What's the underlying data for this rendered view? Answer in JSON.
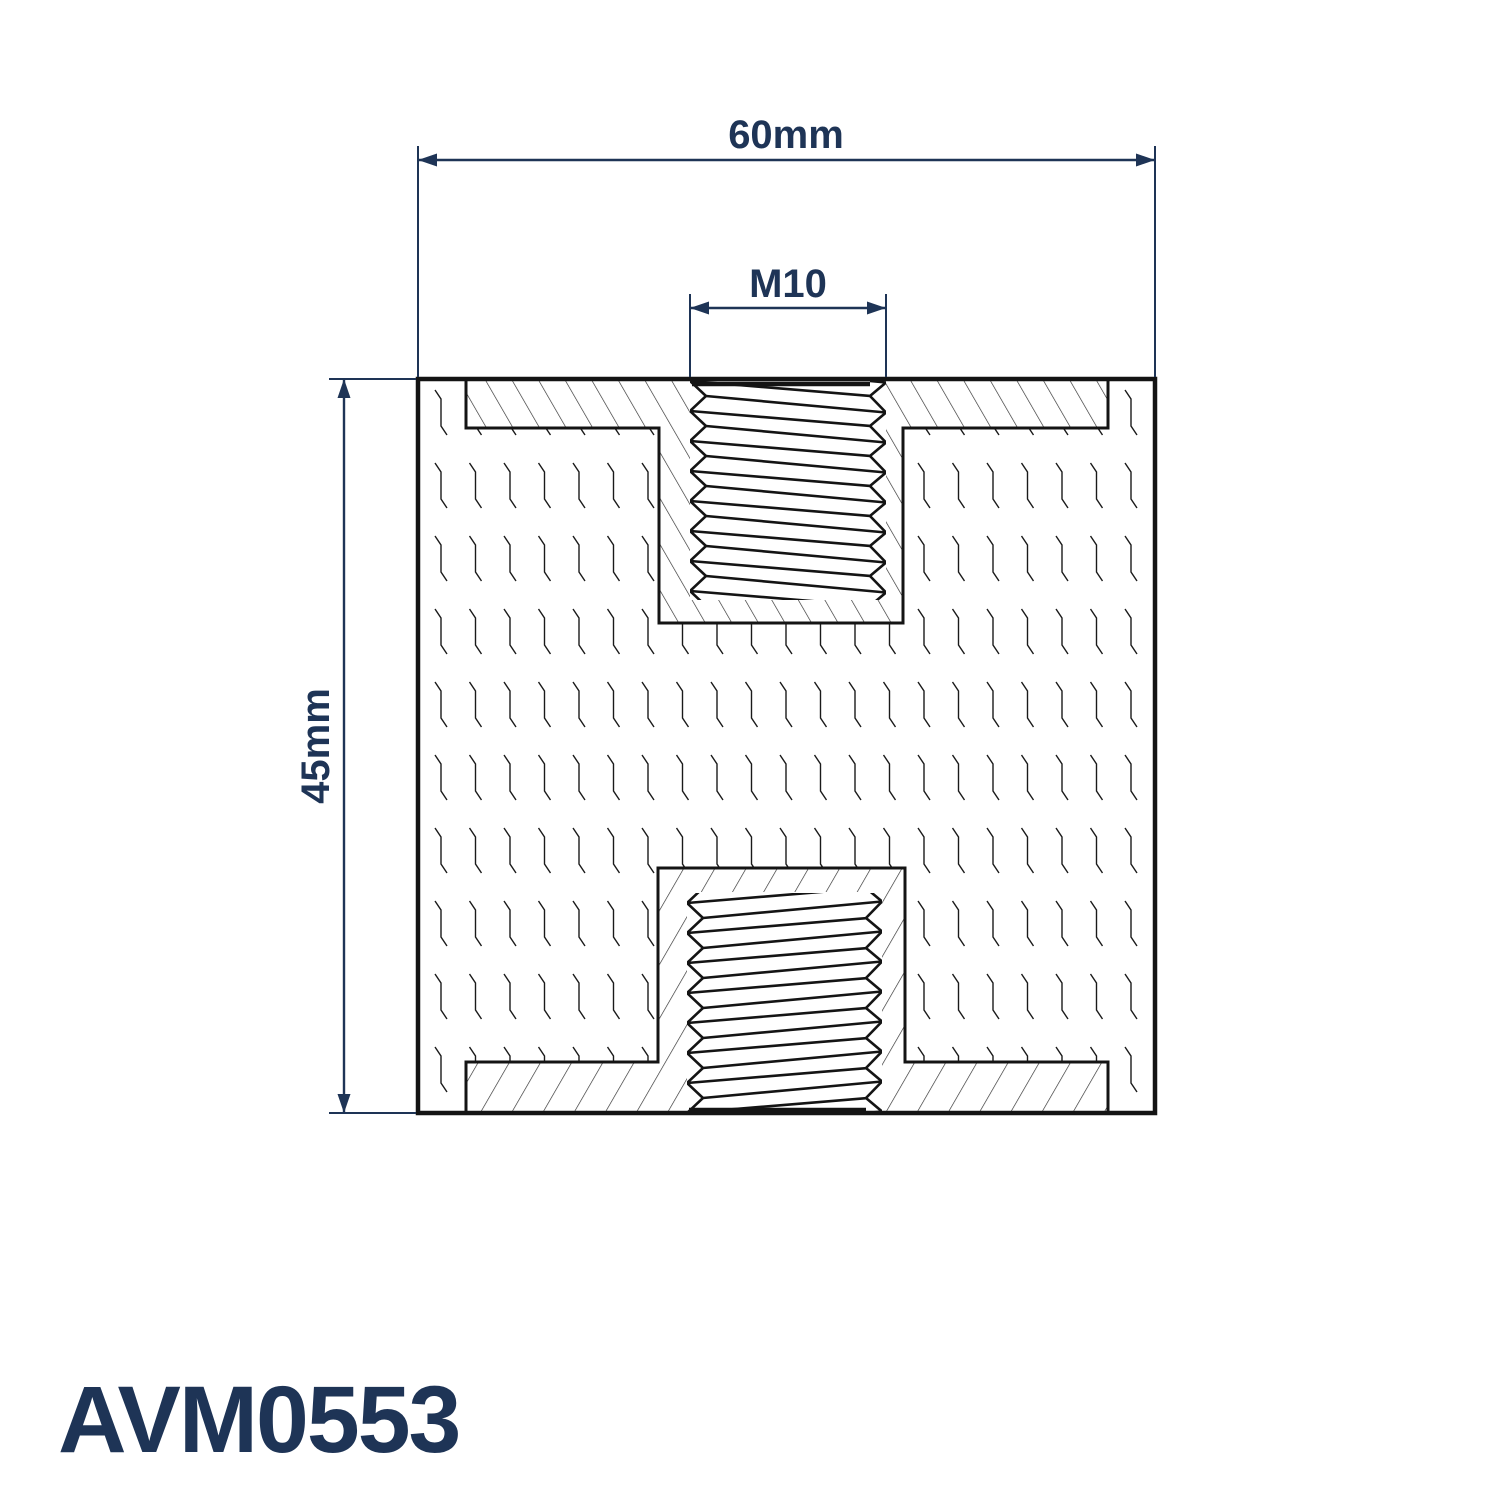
{
  "drawing": {
    "part_number": "AVM0553",
    "dimensions": {
      "width": "60mm",
      "height": "45mm",
      "thread": "M10"
    },
    "colors": {
      "dimension_navy": "#1e3456",
      "line_black": "#141414",
      "hatch_gray": "#2b2b2b",
      "texture_gray": "#1a1a1a",
      "background": "#ffffff"
    }
  }
}
